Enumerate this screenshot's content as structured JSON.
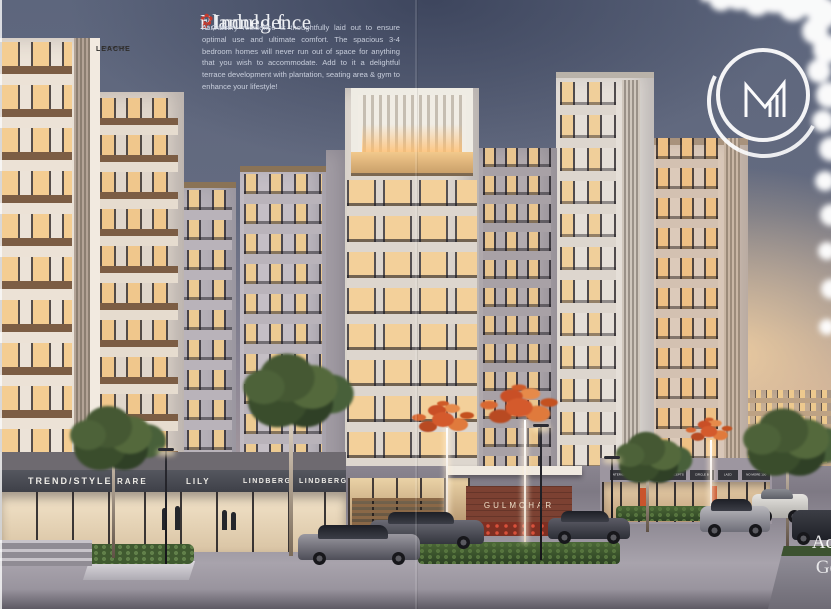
{
  "page": {
    "headline": {
      "pre": "Planned f",
      "flower": "✿",
      "post": "r Indulgence"
    },
    "body": {
      "pre": "At Gulm",
      "flower": "✿",
      "post": "har, every residence is thoughtfully laid out to ensure optimal use and ultimate comfort. The spacious 3-4 bedroom homes will never run out of space for anything that you wish to accommodate. Add to it a delightful terrace development with plantation, seating area & gym to enhance your lifestyle!"
    }
  },
  "logo": {
    "monogram": "M"
  },
  "storefronts": {
    "left_signs": [
      "TREND/STYLE",
      "RARE",
      "LILY",
      "LINDBERG",
      "LINDBERG"
    ],
    "window_sign": {
      "line1": "LEACHE",
      "line2": "LEACHES 90"
    },
    "right_signs": [
      "INTERIOR CONCEPTS",
      "INTERIOR CONCEPTS",
      "CIRCLE B",
      "LAZO",
      "NO MORE 100"
    ]
  },
  "entrance": {
    "sign": "GULMOHAR"
  },
  "corner_text": {
    "line1": "Ac",
    "line2": "Ge"
  },
  "colors": {
    "flower_red": "#c23a2e",
    "brick": "#7c4132",
    "sky_warm": "#e8cba3"
  }
}
